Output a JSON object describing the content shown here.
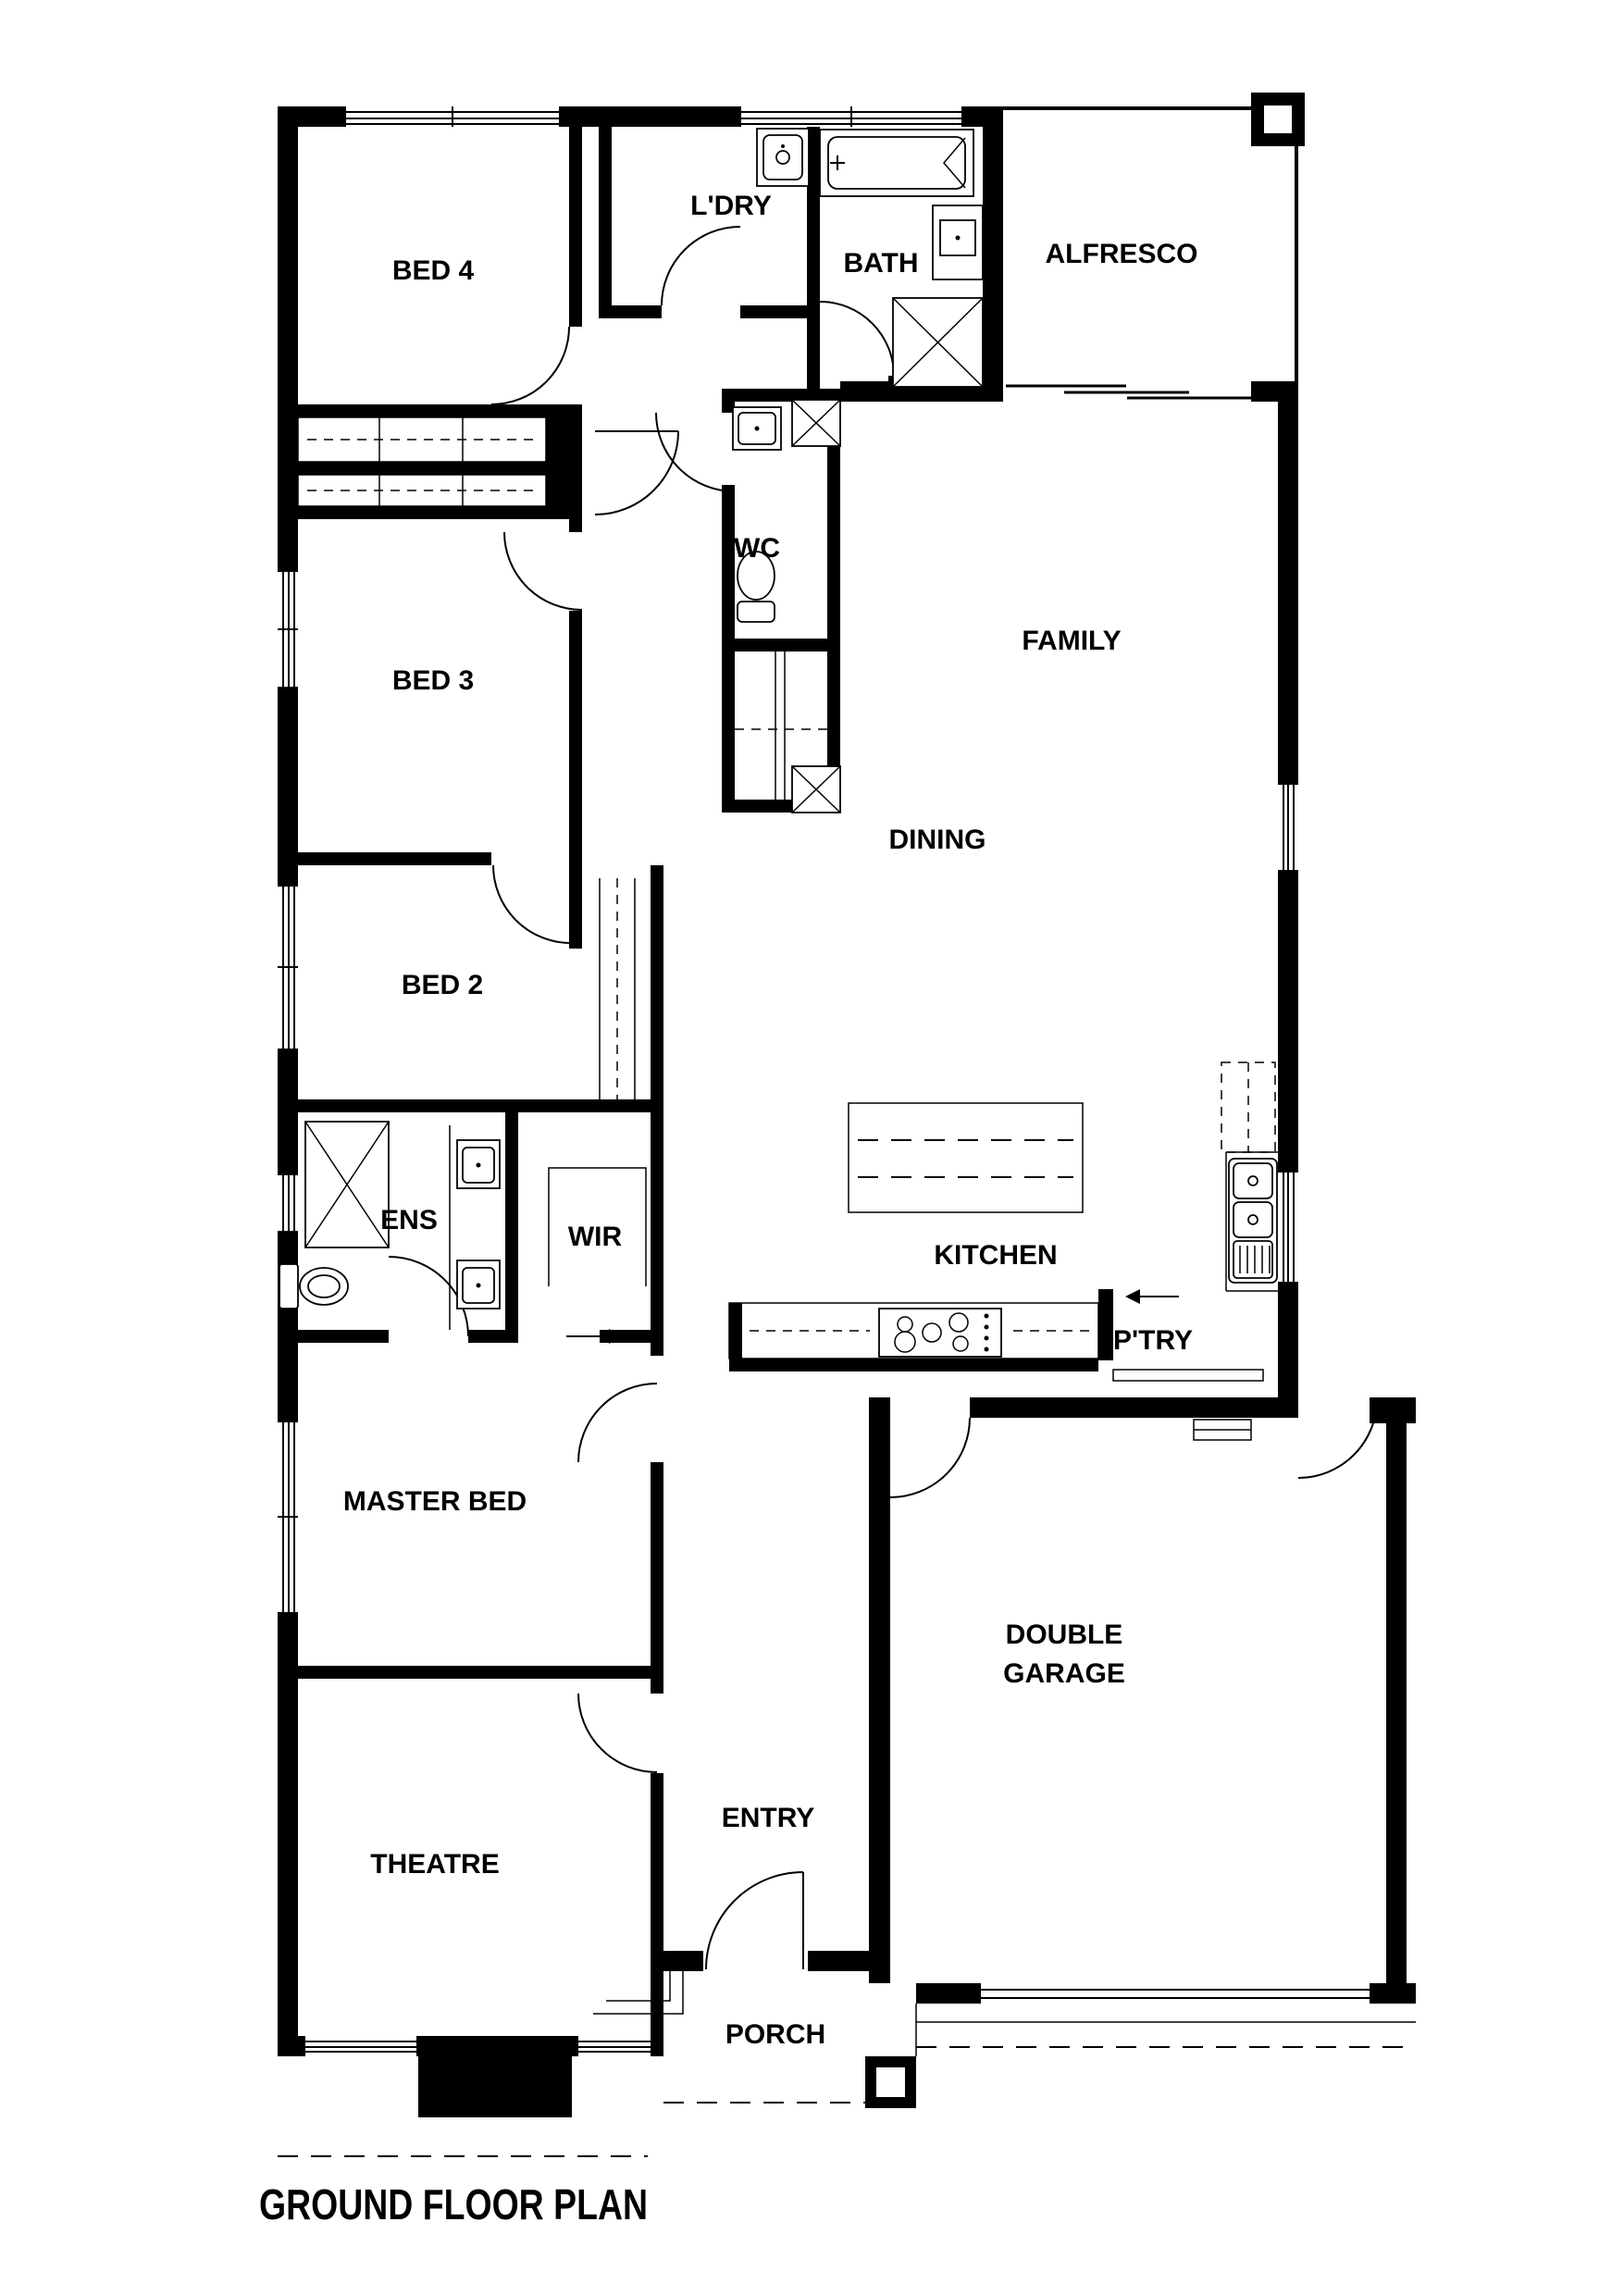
{
  "title": "GROUND FLOOR PLAN",
  "rooms": [
    {
      "id": "bed4",
      "label": "BED 4"
    },
    {
      "id": "ldry",
      "label": "L'DRY"
    },
    {
      "id": "bath",
      "label": "BATH"
    },
    {
      "id": "alfresco",
      "label": "ALFRESCO"
    },
    {
      "id": "wc",
      "label": "WC"
    },
    {
      "id": "family",
      "label": "FAMILY"
    },
    {
      "id": "bed3",
      "label": "BED 3"
    },
    {
      "id": "dining",
      "label": "DINING"
    },
    {
      "id": "bed2",
      "label": "BED 2"
    },
    {
      "id": "ens",
      "label": "ENS"
    },
    {
      "id": "wir",
      "label": "WIR"
    },
    {
      "id": "kitchen",
      "label": "KITCHEN"
    },
    {
      "id": "ptry",
      "label": "P'TRY"
    },
    {
      "id": "master",
      "label": "MASTER BED"
    },
    {
      "id": "garage",
      "label": "DOUBLE GARAGE",
      "lines": [
        "DOUBLE",
        "GARAGE"
      ]
    },
    {
      "id": "theatre",
      "label": "THEATRE"
    },
    {
      "id": "entry",
      "label": "ENTRY"
    },
    {
      "id": "porch",
      "label": "PORCH"
    }
  ],
  "colors": {
    "walls": "#000000",
    "background": "#ffffff"
  }
}
